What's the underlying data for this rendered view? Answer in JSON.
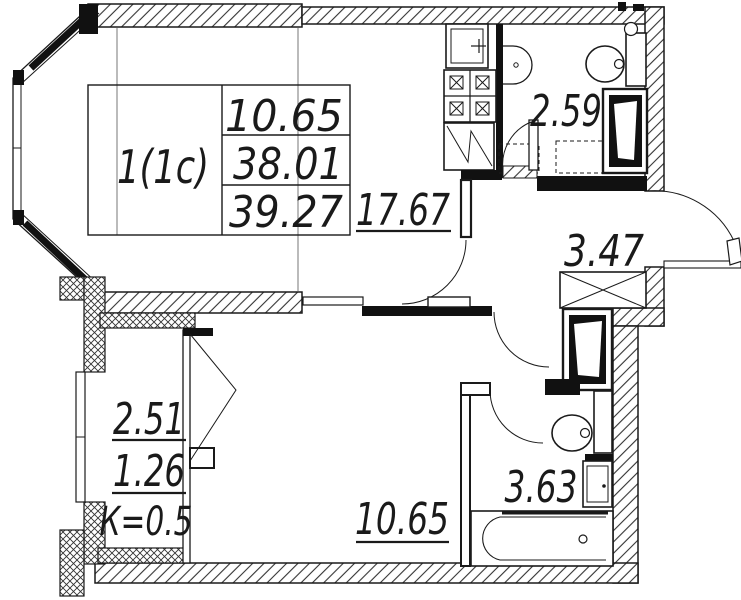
{
  "stamp": {
    "apartment_type": "1(1с)",
    "room_area": "10.65",
    "living_area": "38.01",
    "total_area": "39.27"
  },
  "rooms": {
    "kitchen_living": "17.67",
    "wc": "2.59",
    "hall": "3.47",
    "bedroom": "10.65",
    "bathroom": "3.63",
    "balcony_full": "2.51",
    "balcony_counted": "1.26",
    "balcony_coefficient": "К=0.5"
  },
  "colors": {
    "line": "#1a1a1a",
    "hatch": "#333333",
    "background": "#ffffff"
  }
}
